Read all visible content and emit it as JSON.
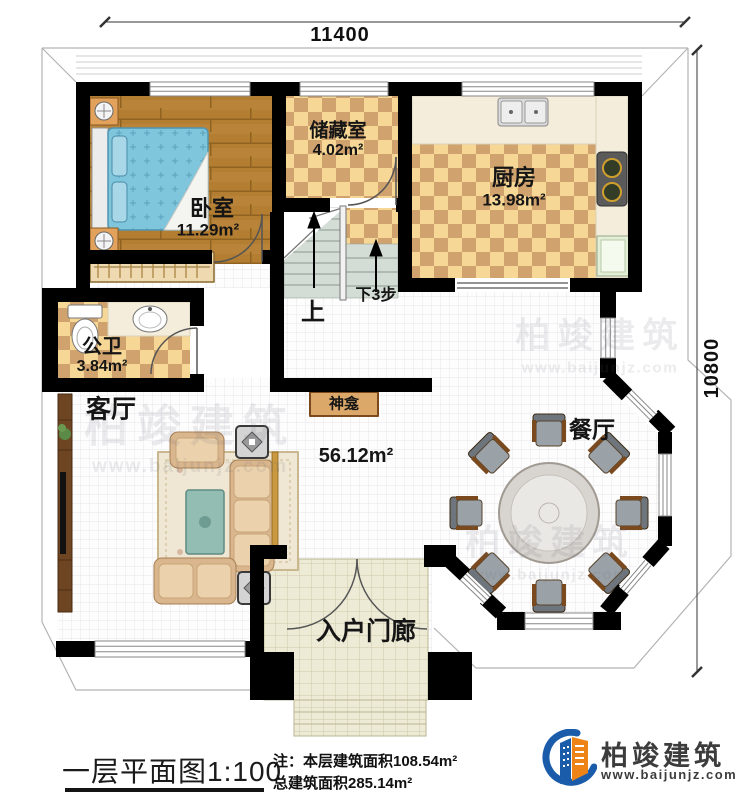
{
  "dimensions": {
    "top": "11400",
    "right": "10800"
  },
  "rooms": {
    "bedroom": {
      "name": "卧室",
      "area": "11.29m²"
    },
    "storage": {
      "name": "储藏室",
      "area": "4.02m²"
    },
    "kitchen": {
      "name": "厨房",
      "area": "13.98m²"
    },
    "bathroom": {
      "name": "公卫",
      "area": "3.84m²"
    },
    "living": {
      "name": "客厅"
    },
    "living_dining_area": "56.12m²",
    "dining": {
      "name": "餐厅"
    },
    "shrine": {
      "name": "神龛"
    },
    "porch": {
      "name": "入户门廊"
    }
  },
  "stairs": {
    "up_label": "上",
    "down_label": "下3步"
  },
  "title_block": {
    "title": "一层平面图",
    "scale": "1:100",
    "note_line1": "注：本层建筑面积108.54m²",
    "note_line2": "总建筑面积285.14m²"
  },
  "logo": {
    "name": "柏竣建筑",
    "website": "www.baijunjz.com"
  },
  "watermark": {
    "text": "柏竣建筑",
    "url": "www.baijunjz.com"
  },
  "colors": {
    "wall": "#000000",
    "checker_light": "#f6d795",
    "checker_dark": "#d0a26e",
    "wood_floor": "#b37d32",
    "logo_blue": "#1a5caa",
    "logo_orange": "#ee8418"
  }
}
